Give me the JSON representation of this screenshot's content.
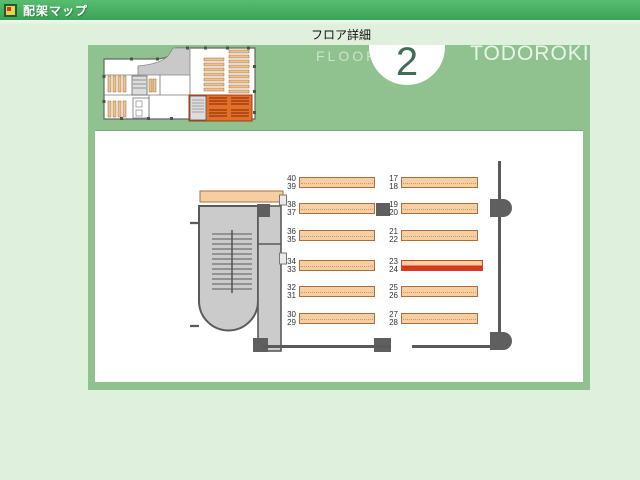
{
  "window": {
    "title": "配架マップ",
    "icon": "map-app-icon"
  },
  "header": {
    "page_label": "フロア詳細",
    "floor_word": "FLOOR",
    "floor_number": "2",
    "location_name": "TODOROKI"
  },
  "map": {
    "highlighted_shelf": "24",
    "rows": [
      {
        "left_top": "40",
        "left_bottom": "39",
        "right_top": "17",
        "right_bottom": "18"
      },
      {
        "left_top": "38",
        "left_bottom": "37",
        "right_top": "19",
        "right_bottom": "20"
      },
      {
        "left_top": "36",
        "left_bottom": "35",
        "right_top": "21",
        "right_bottom": "22"
      },
      {
        "left_top": "34",
        "left_bottom": "33",
        "right_top": "23",
        "right_bottom": "24"
      },
      {
        "left_top": "32",
        "left_bottom": "31",
        "right_top": "25",
        "right_bottom": "26"
      },
      {
        "left_top": "30",
        "left_bottom": "29",
        "right_top": "27",
        "right_bottom": "28"
      }
    ]
  },
  "colors": {
    "titlebar_green": "#44ae5e",
    "background_green": "#dff0dc",
    "panel_green": "#8fc28f",
    "shelf_fill": "#f5cfa2",
    "shelf_border": "#ad6d3d",
    "highlight_red": "#e2331f",
    "wall_gray": "#5a5a5a",
    "floor_gray": "#c9c9c9",
    "thumbnail_region_orange": "#e0702a"
  }
}
